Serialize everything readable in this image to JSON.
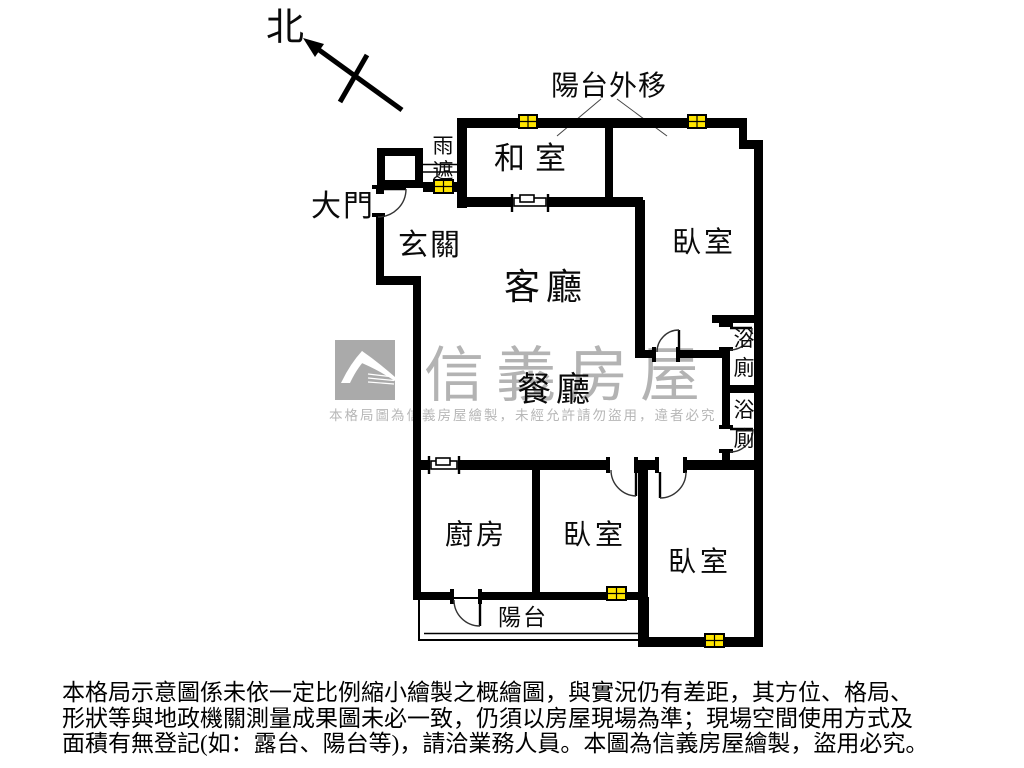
{
  "labels": {
    "north": "北",
    "balcony_out": "陽台外移",
    "main_door": "大門",
    "rain_cover": [
      "雨",
      "遮"
    ]
  },
  "rooms": {
    "entry": "玄關",
    "tatami": "和室",
    "living": "客廳",
    "dining": "餐廳",
    "bedroom_top_right": "臥室",
    "bedroom_bottom_middle": "臥室",
    "bedroom_bottom_right": "臥室",
    "kitchen": "廚房",
    "bath_upper": [
      "浴",
      "廁"
    ],
    "bath_lower": [
      "浴",
      "廁"
    ],
    "balcony": "陽台"
  },
  "watermark": {
    "brand": "信義房屋",
    "notice": "本格局圖為信義房屋繪製，未經允許請勿盜用，違者必究"
  },
  "disclaimer": {
    "lines": [
      "本格局示意圖係未依一定比例縮小繪製之概繪圖，與實況仍有差距，其方位、格局、",
      "形狀等與地政機關測量成果圖未必一致，仍須以房屋現場為準；現場空間使用方式及",
      "面積有無登記(如：露台、陽台等)，請洽業務人員。本圖為信義房屋繪製，盜用必究。"
    ]
  },
  "colors": {
    "wall": "#000000",
    "window": "#ffe500",
    "watermark": "#b3b3b3",
    "background": "#ffffff"
  }
}
